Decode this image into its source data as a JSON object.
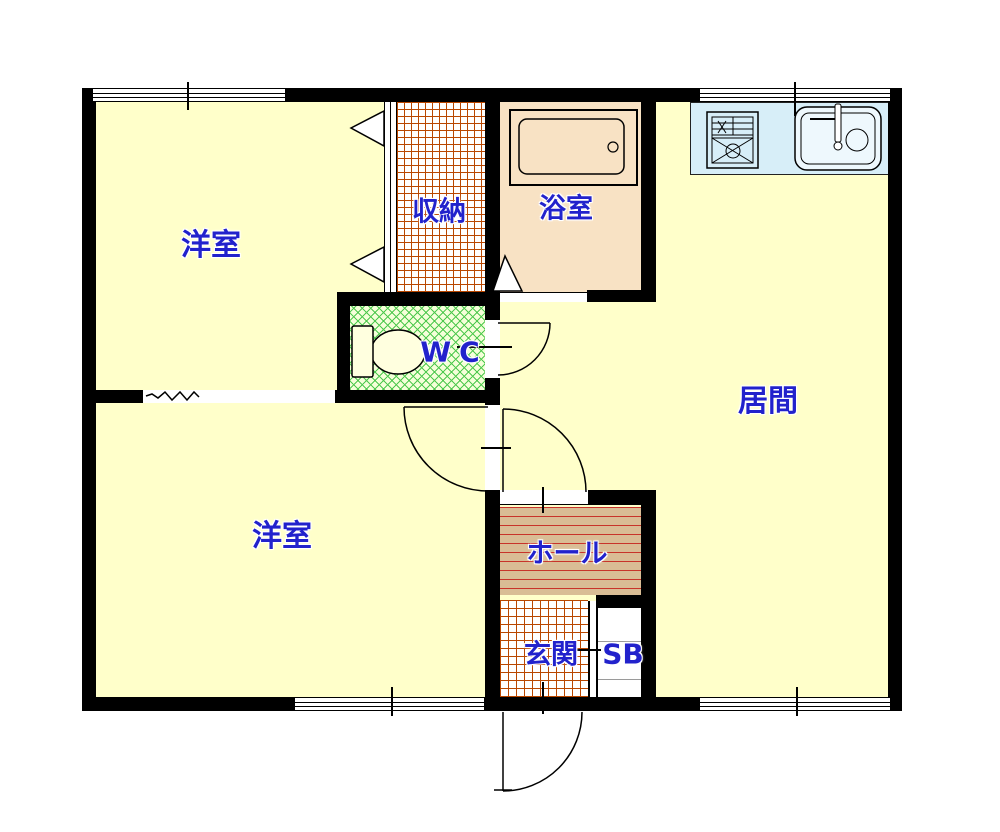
{
  "title": "apartment floor plan",
  "rooms": {
    "bedroom_top": {
      "label": "洋室"
    },
    "storage": {
      "label": "収納"
    },
    "bathroom": {
      "label": "浴室"
    },
    "living_room": {
      "label": "居間"
    },
    "wc": {
      "label": "WC"
    },
    "bedroom_bottom": {
      "label": "洋室"
    },
    "hall": {
      "label": "ホール"
    },
    "entrance": {
      "label": "玄関"
    },
    "shoe_box": {
      "label": "SB"
    }
  },
  "fixtures": [
    "toilet",
    "bathtub",
    "gas-stove",
    "kitchen-sink",
    "bi-fold-closet-doors",
    "swing-doors",
    "sliding-bath-door",
    "windows"
  ],
  "colors": {
    "wall": "#000000",
    "floor_fill": "#FFFFCA",
    "bath_fill": "#F8E2C4",
    "kitchen_counter_fill": "#D7EEF8",
    "wc_hatch_line": "#4EC94E",
    "wc_hatch_bg": "#F5FFD9",
    "storage_entrance_grid_line": "#B94700",
    "hall_fill": "#D9BD95",
    "hall_hatch_line": "#C8342A",
    "label_text": "#2222CC"
  }
}
